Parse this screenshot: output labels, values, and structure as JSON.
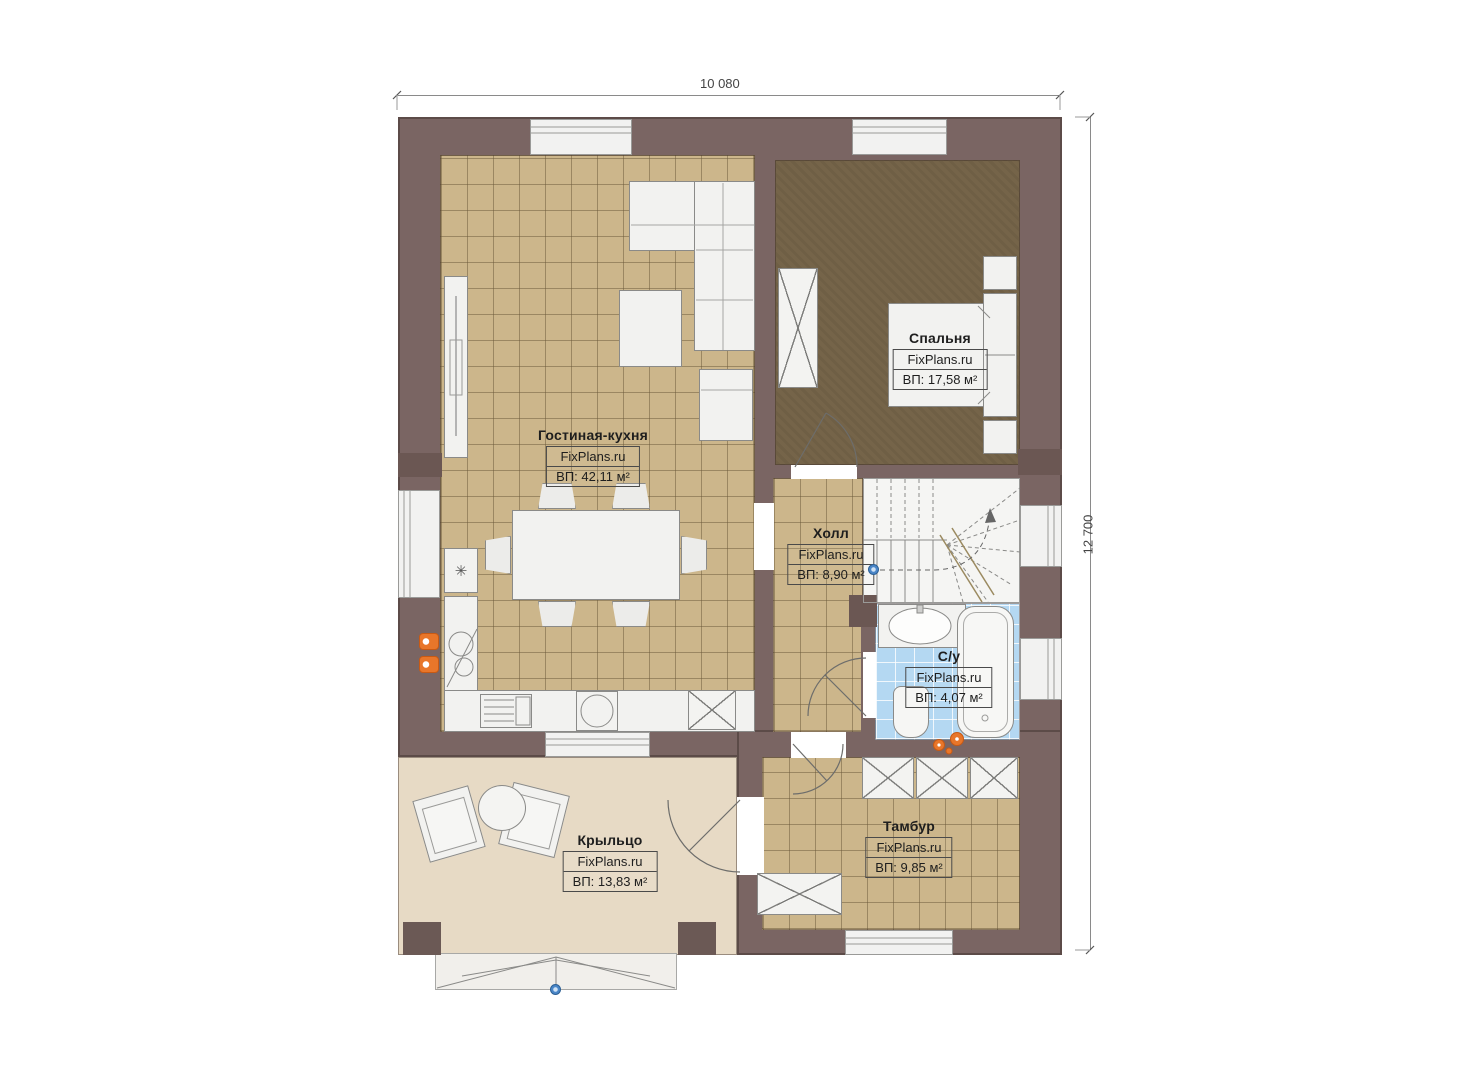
{
  "plan": {
    "watermark": "FixPlans.ru",
    "dimension_width": "10 080",
    "dimension_height": "12 700",
    "rooms": {
      "living": {
        "name": "Гостиная-кухня",
        "area": "ВП: 42,11 м²"
      },
      "bedroom": {
        "name": "Спальня",
        "area": "ВП: 17,58 м²"
      },
      "hall": {
        "name": "Холл",
        "area": "ВП: 8,90 м²"
      },
      "bathroom": {
        "name": "С/у",
        "area": "ВП: 4,07 м²"
      },
      "tambour": {
        "name": "Тамбур",
        "area": "ВП: 9,85 м²"
      },
      "porch": {
        "name": "Крыльцо",
        "area": "ВП: 13,83 м²"
      }
    },
    "icons": {
      "fridge": "✳"
    },
    "colors": {
      "wall": "#7a6563",
      "tile_floor": "#ccb68b",
      "bedroom_floor": "#756449",
      "bath_tile": "#b4d8f2",
      "porch_floor": "#e7dac5",
      "marker": "#4a86c8",
      "burner": "#e8762a"
    }
  }
}
